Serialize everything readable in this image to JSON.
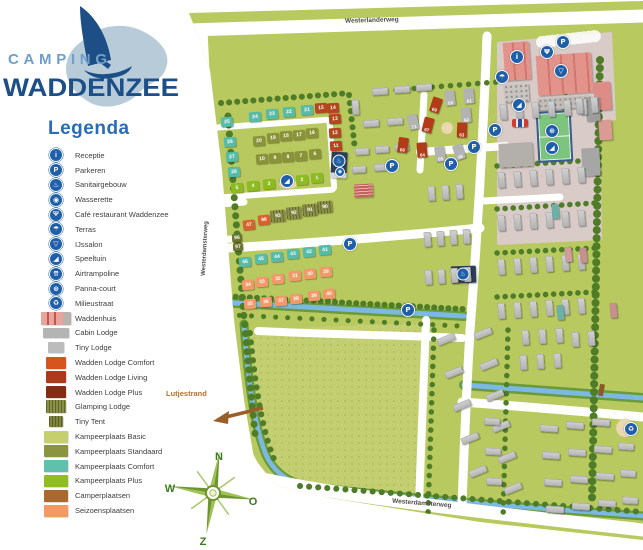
{
  "logo": {
    "line1": "CAMPING",
    "line2": "WADDENZEE"
  },
  "legend": {
    "title": "Legenda",
    "items": [
      {
        "id": "receptie",
        "label": "Receptie",
        "icon": {
          "kind": "circle",
          "name": "info-icon",
          "glyph": "i"
        }
      },
      {
        "id": "parkeren",
        "label": "Parkeren",
        "icon": {
          "kind": "circle",
          "name": "parking-icon",
          "glyph": "P"
        }
      },
      {
        "id": "sanitairgebouw",
        "label": "Sanitairgebouw",
        "icon": {
          "kind": "circle",
          "name": "sanitary-icon",
          "glyph": "♨"
        }
      },
      {
        "id": "wasserette",
        "label": "Wasserette",
        "icon": {
          "kind": "circle",
          "name": "laundry-icon",
          "glyph": "◉"
        }
      },
      {
        "id": "cafe-restaurant",
        "label": "Café restaurant Waddenzee",
        "icon": {
          "kind": "circle",
          "name": "restaurant-icon",
          "glyph": "Ψ"
        }
      },
      {
        "id": "terras",
        "label": "Terras",
        "icon": {
          "kind": "circle",
          "name": "terrace-icon",
          "glyph": "☂"
        }
      },
      {
        "id": "ijssalon",
        "label": "IJssalon",
        "icon": {
          "kind": "circle",
          "name": "icecream-icon",
          "glyph": "▽"
        }
      },
      {
        "id": "speeltuin",
        "label": "Speeltuin",
        "icon": {
          "kind": "circle",
          "name": "playground-icon",
          "glyph": "◢"
        }
      },
      {
        "id": "airtrampoline",
        "label": "Airtrampoline",
        "icon": {
          "kind": "circle",
          "name": "trampoline-icon",
          "glyph": "⇈"
        }
      },
      {
        "id": "panna-court",
        "label": "Panna-court",
        "icon": {
          "kind": "circle",
          "name": "soccer-icon",
          "glyph": "⊛"
        }
      },
      {
        "id": "milieustraat",
        "label": "Milieustraat",
        "icon": {
          "kind": "circle",
          "name": "recycle-icon",
          "glyph": "♻"
        }
      },
      {
        "id": "waddenhuis",
        "label": "Waddenhuis",
        "icon": {
          "kind": "swatch",
          "name": "waddenhuis-swatch",
          "variant": "waddenhuis",
          "color": "#e7a59e",
          "w": 30,
          "h": 13
        }
      },
      {
        "id": "cabin-lodge",
        "label": "Cabin Lodge",
        "icon": {
          "kind": "swatch",
          "name": "cabin-lodge-swatch",
          "color": "#b4b4b4",
          "w": 26,
          "h": 10
        }
      },
      {
        "id": "tiny-lodge",
        "label": "Tiny Lodge",
        "icon": {
          "kind": "swatch",
          "name": "tiny-lodge-swatch",
          "color": "#bcbcbc",
          "w": 16,
          "h": 11
        }
      },
      {
        "id": "wadden-lodge-comfort",
        "label": "Wadden Lodge Comfort",
        "icon": {
          "kind": "swatch",
          "name": "wadden-lodge-comfort-swatch",
          "color": "#d8541f",
          "w": 20,
          "h": 12
        }
      },
      {
        "id": "wadden-lodge-living",
        "label": "Wadden Lodge Living",
        "icon": {
          "kind": "swatch",
          "name": "wadden-lodge-living-swatch",
          "color": "#ac3a1a",
          "w": 20,
          "h": 12
        }
      },
      {
        "id": "wadden-lodge-plus",
        "label": "Wadden Lodge Plus",
        "icon": {
          "kind": "swatch",
          "name": "wadden-lodge-plus-swatch",
          "color": "#842d14",
          "w": 20,
          "h": 12
        }
      },
      {
        "id": "glamping-lodge",
        "label": "Glamping Lodge",
        "icon": {
          "kind": "swatch",
          "name": "glamping-lodge-swatch",
          "color": "#8a8f48",
          "w": 20,
          "h": 13,
          "striped": true
        }
      },
      {
        "id": "tiny-tent",
        "label": "Tiny Tent",
        "icon": {
          "kind": "swatch",
          "name": "tiny-tent-swatch",
          "color": "#7f8440",
          "w": 14,
          "h": 11,
          "striped": true
        }
      },
      {
        "id": "kampeerplaats-basic",
        "label": "Kampeerplaats Basic",
        "icon": {
          "kind": "swatch",
          "name": "kampeerplaats-basic-swatch",
          "color": "#c6cf6d",
          "w": 24,
          "h": 12
        }
      },
      {
        "id": "kampeerplaats-standaard",
        "label": "Kampeerplaats Standaard",
        "icon": {
          "kind": "swatch",
          "name": "kampeerplaats-standaard-swatch",
          "color": "#8b9440",
          "w": 24,
          "h": 12
        }
      },
      {
        "id": "kampeerplaats-comfort",
        "label": "Kampeerplaats Comfort",
        "icon": {
          "kind": "swatch",
          "name": "kampeerplaats-comfort-swatch",
          "color": "#5fc0ab",
          "w": 24,
          "h": 12
        }
      },
      {
        "id": "kampeerplaats-plus",
        "label": "Kampeerplaats Plus",
        "icon": {
          "kind": "swatch",
          "name": "kampeerplaats-plus-swatch",
          "color": "#90bd20",
          "w": 24,
          "h": 12
        }
      },
      {
        "id": "camperplaatsen",
        "label": "Camperplaatsen",
        "icon": {
          "kind": "swatch",
          "name": "camperplaatsen-swatch",
          "color": "#a8682e",
          "w": 24,
          "h": 12
        }
      },
      {
        "id": "seizoensplaatsen",
        "label": "Seizoensplaatsen",
        "icon": {
          "kind": "swatch",
          "name": "seizoensplaatsen-swatch",
          "color": "#f29a63",
          "w": 24,
          "h": 12
        }
      }
    ]
  },
  "map": {
    "roads": {
      "top": "Westerlanderweg",
      "left": "Westerdamsterweg",
      "bottom": "Westerdamsterweg"
    },
    "beach_label": "Lutjestrand",
    "compass": {
      "n": "N",
      "w": "W",
      "o": "O",
      "z": "Z"
    },
    "plot_groups": [
      {
        "id": "comfort-a",
        "color": "#56bca8",
        "rot": -4,
        "items": [
          [
            "21",
            307,
            110
          ],
          [
            "22",
            289,
            112
          ],
          [
            "23",
            272,
            114
          ],
          [
            "24",
            255,
            117
          ],
          [
            "25",
            227,
            122
          ],
          [
            "26",
            230,
            142
          ],
          [
            "27",
            232,
            157
          ],
          [
            "28",
            234,
            172
          ]
        ]
      },
      {
        "id": "comfort-b",
        "color": "#56bca8",
        "rot": -4,
        "items": [
          [
            "41",
            325,
            250
          ],
          [
            "42",
            309,
            252
          ],
          [
            "43",
            293,
            254
          ],
          [
            "44",
            277,
            257
          ],
          [
            "45",
            261,
            259
          ],
          [
            "46",
            245,
            262
          ]
        ]
      },
      {
        "id": "plus",
        "color": "#8dbc20",
        "rot": -4,
        "items": [
          [
            "1",
            317,
            178
          ],
          [
            "2",
            302,
            180
          ],
          [
            "3",
            269,
            184
          ],
          [
            "4",
            253,
            186
          ],
          [
            "5",
            237,
            188
          ]
        ]
      },
      {
        "id": "standaard-a",
        "color": "#8b9339",
        "rot": -4,
        "items": [
          [
            "16",
            312,
            133
          ],
          [
            "17",
            299,
            135
          ],
          [
            "18",
            286,
            136
          ],
          [
            "19",
            273,
            138
          ],
          [
            "20",
            259,
            141
          ]
        ]
      },
      {
        "id": "standaard-b",
        "color": "#8b9339",
        "rot": -4,
        "items": [
          [
            "6",
            315,
            154
          ],
          [
            "7",
            301,
            156
          ],
          [
            "8",
            288,
            157
          ],
          [
            "9",
            275,
            158
          ],
          [
            "10",
            262,
            159
          ]
        ]
      },
      {
        "id": "wadden-lodge-row",
        "color": "#b5451c",
        "rot": -4,
        "items": [
          [
            "15",
            321,
            108
          ],
          [
            "14",
            333,
            108
          ],
          [
            "13",
            335,
            119
          ],
          [
            "12",
            335,
            133
          ],
          [
            "11",
            336,
            146
          ]
        ]
      },
      {
        "id": "lodge-47-98",
        "color": "#d8622d",
        "rot": -6,
        "items": [
          [
            "47",
            249,
            225
          ],
          [
            "98",
            264,
            220
          ]
        ]
      },
      {
        "id": "tiny-96-97",
        "color": "#6e7430",
        "rot": -4,
        "size": [
          10,
          8
        ],
        "items": [
          [
            "96",
            237,
            238
          ],
          [
            "97",
            238,
            247
          ]
        ]
      },
      {
        "id": "glamping",
        "color": "#8d9148",
        "rot": -5,
        "striped": true,
        "size": [
          15,
          12
        ],
        "items": [
          [
            "90",
            325,
            207
          ],
          [
            "91",
            310,
            210
          ],
          [
            "92",
            294,
            213
          ],
          [
            "93",
            278,
            216
          ]
        ]
      },
      {
        "id": "seizoen-a",
        "color": "#f2996a",
        "rot": -5,
        "items": [
          [
            "29",
            326,
            272
          ],
          [
            "30",
            310,
            274
          ],
          [
            "31",
            295,
            276
          ],
          [
            "32",
            278,
            279
          ],
          [
            "33",
            262,
            282
          ],
          [
            "34",
            248,
            285
          ]
        ]
      },
      {
        "id": "seizoen-b",
        "color": "#f2996a",
        "rot": -5,
        "items": [
          [
            "35",
            250,
            304
          ],
          [
            "36",
            266,
            302
          ],
          [
            "37",
            281,
            301
          ],
          [
            "38",
            296,
            299
          ],
          [
            "39",
            314,
            296
          ],
          [
            "40",
            329,
            294
          ]
        ]
      }
    ],
    "lodges": [
      [
        "60",
        450,
        98,
        "gray",
        -8
      ],
      [
        "61",
        469,
        96,
        "gray",
        -5
      ],
      [
        "69",
        436,
        105,
        "red",
        18
      ],
      [
        "71",
        413,
        122,
        "gray",
        -12
      ],
      [
        "62",
        466,
        115,
        "gray",
        -6
      ],
      [
        "67",
        428,
        125,
        "red",
        14
      ],
      [
        "63",
        462,
        130,
        "red",
        2
      ],
      [
        "68",
        403,
        145,
        "red",
        8
      ],
      [
        "64",
        422,
        150,
        "red",
        -4
      ],
      [
        "65",
        440,
        154,
        "gray",
        -8
      ],
      [
        "66",
        459,
        152,
        "gray",
        -18
      ]
    ],
    "icons": [
      {
        "name": "parking-icon",
        "glyph": "P",
        "x": 563,
        "y": 42
      },
      {
        "name": "parking-icon",
        "glyph": "P",
        "x": 495,
        "y": 130
      },
      {
        "name": "parking-icon",
        "glyph": "P",
        "x": 474,
        "y": 147
      },
      {
        "name": "parking-icon",
        "glyph": "P",
        "x": 451,
        "y": 164
      },
      {
        "name": "parking-icon",
        "glyph": "P",
        "x": 392,
        "y": 166
      },
      {
        "name": "parking-icon",
        "glyph": "P",
        "x": 350,
        "y": 244
      },
      {
        "name": "parking-icon",
        "glyph": "P",
        "x": 408,
        "y": 310
      },
      {
        "name": "info-icon",
        "glyph": "i",
        "x": 517,
        "y": 57
      },
      {
        "name": "restaurant-icon",
        "glyph": "Ψ",
        "x": 547,
        "y": 52
      },
      {
        "name": "icecream-icon",
        "glyph": "▽",
        "x": 561,
        "y": 71
      },
      {
        "name": "terrace-icon",
        "glyph": "☂",
        "x": 502,
        "y": 77
      },
      {
        "name": "sanitary-icon",
        "glyph": "♨",
        "x": 339,
        "y": 161,
        "s": 11
      },
      {
        "name": "laundry-icon",
        "glyph": "◉",
        "x": 340,
        "y": 172,
        "s": 8
      },
      {
        "name": "sanitary-icon",
        "glyph": "♨",
        "x": 463,
        "y": 274,
        "s": 11
      },
      {
        "name": "playground-icon",
        "glyph": "◢",
        "x": 287,
        "y": 181
      },
      {
        "name": "playground-icon",
        "glyph": "◢",
        "x": 519,
        "y": 105
      },
      {
        "name": "playground-icon",
        "glyph": "◢",
        "x": 552,
        "y": 148
      },
      {
        "name": "soccer-icon",
        "glyph": "⊛",
        "x": 552,
        "y": 131
      },
      {
        "name": "recycle-icon",
        "glyph": "♻",
        "x": 631,
        "y": 429
      }
    ]
  },
  "colors": {
    "map_green": "#b8c95f",
    "field_texture": "#c3ce70",
    "water": "#7cb9e2",
    "water_bank": "#6b9a3a",
    "hedge": "#4e7c27",
    "road": "#ffffff",
    "icon_blue": "#1f5ea8",
    "paved": "#d9cbc7",
    "building_pink": "#e7a59e",
    "navy_building": "#2e3d56",
    "court_green": "#7cc57e",
    "legend_title_blue": "#2b6cb8",
    "logo_light_blue": "#6f9fca",
    "logo_dark_blue": "#1c4e87",
    "island_blue": "#b7ccd8",
    "beach_label_color": "#b5722c",
    "compass_green": "#8ab33b"
  }
}
